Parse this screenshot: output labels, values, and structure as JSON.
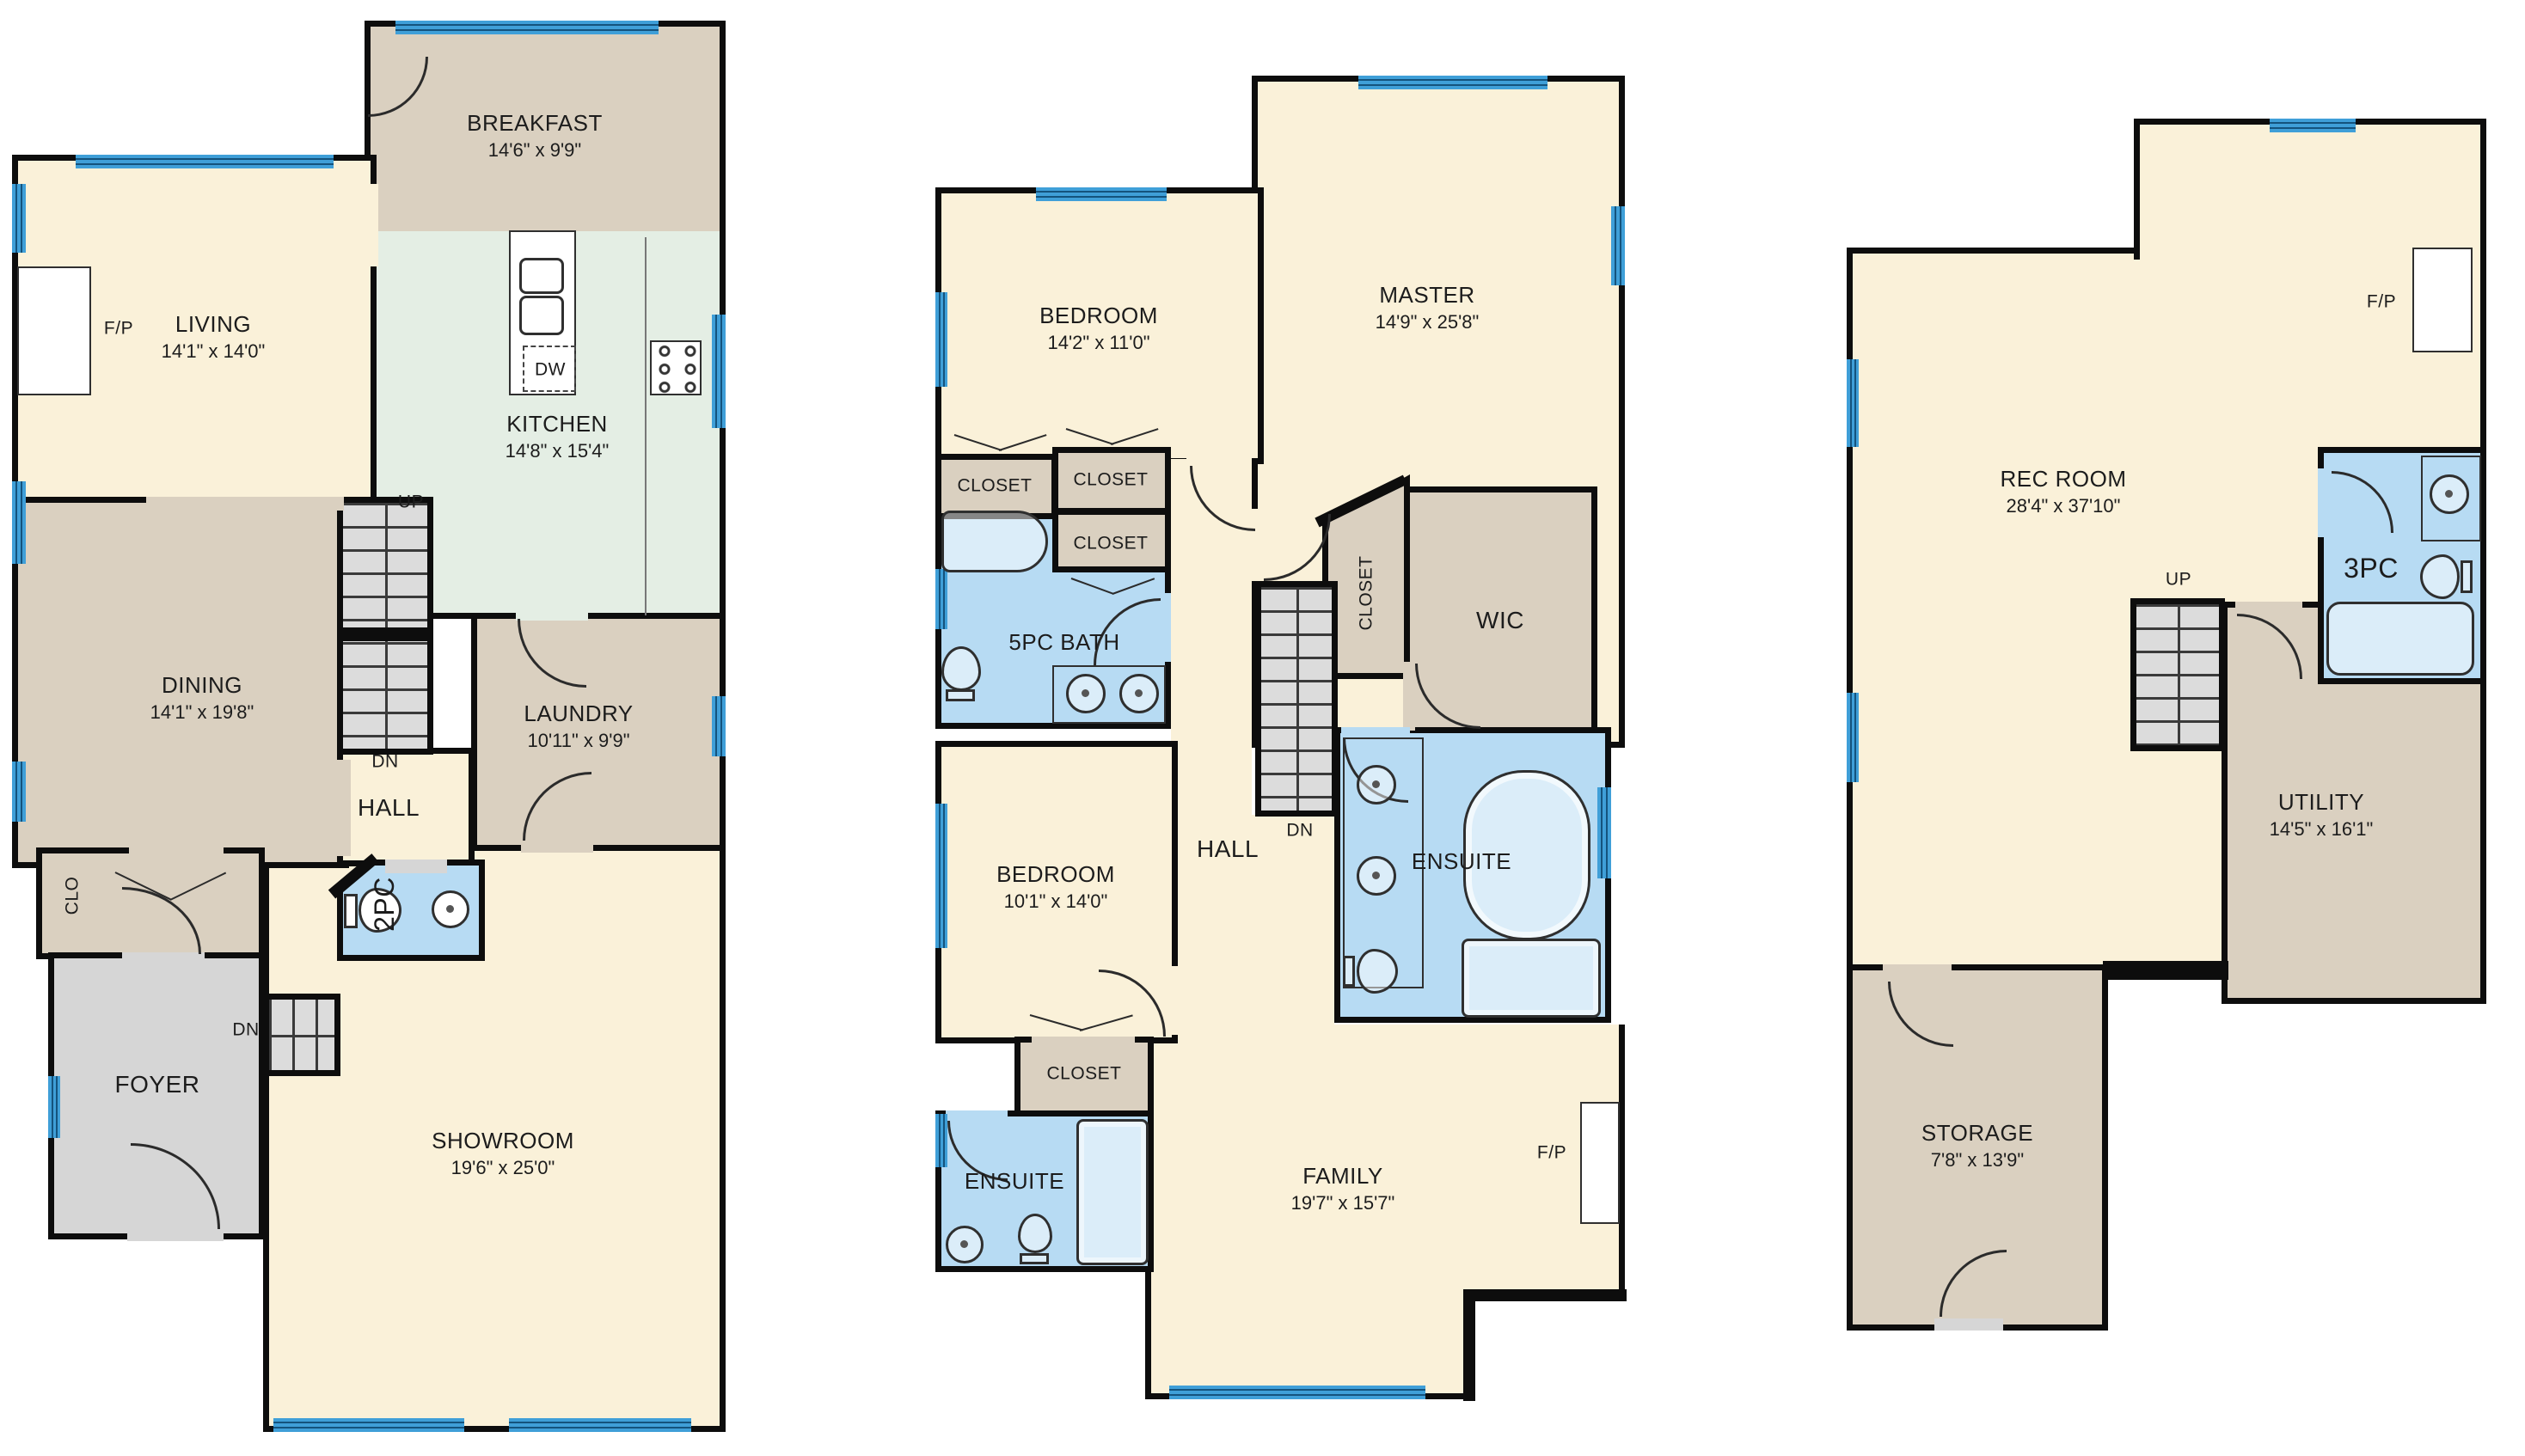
{
  "colors": {
    "wall": "#0d0d0d",
    "cream": "#FAF1D9",
    "tan": "#DAD0C0",
    "kitchen_green": "#E4EEE4",
    "bath_blue": "#B7DBF3",
    "window_blue": "#3F9FD8",
    "foyer_gray": "#D6D6D6",
    "stair_gray": "#DCDCDC"
  },
  "floor1": {
    "living": {
      "name": "LIVING",
      "dims": "14'1\" x 14'0\""
    },
    "breakfast": {
      "name": "BREAKFAST",
      "dims": "14'6\" x 9'9\""
    },
    "kitchen": {
      "name": "KITCHEN",
      "dims": "14'8\" x 15'4\""
    },
    "dining": {
      "name": "DINING",
      "dims": "14'1\" x 19'8\""
    },
    "laundry": {
      "name": "LAUNDRY",
      "dims": "10'11\" x 9'9\""
    },
    "showroom": {
      "name": "SHOWROOM",
      "dims": "19'6\" x 25'0\""
    },
    "hall": "HALL",
    "wc": "2PC",
    "closet": "CLO",
    "foyer": "FOYER",
    "fireplace": "F/P",
    "dishwasher": "DW",
    "up": "UP",
    "down": "DN"
  },
  "floor2": {
    "bedroom1": {
      "name": "BEDROOM",
      "dims": "14'2\" x 11'0\""
    },
    "master": {
      "name": "MASTER",
      "dims": "14'9\" x 25'8\""
    },
    "bath": "5PC BATH",
    "closet": "CLOSET",
    "wic": "WIC",
    "bedroom2": {
      "name": "BEDROOM",
      "dims": "10'1\" x 14'0\""
    },
    "hall": "HALL",
    "ensuite": "ENSUITE",
    "family": {
      "name": "FAMILY",
      "dims": "19'7\" x 15'7\""
    },
    "fireplace": "F/P",
    "down": "DN"
  },
  "floor3": {
    "rec": {
      "name": "REC ROOM",
      "dims": "28'4\" x 37'10\""
    },
    "bath": "3PC",
    "utility": {
      "name": "UTILITY",
      "dims": "14'5\" x 16'1\""
    },
    "storage": {
      "name": "STORAGE",
      "dims": "7'8\" x 13'9\""
    },
    "fireplace": "F/P",
    "up": "UP"
  }
}
